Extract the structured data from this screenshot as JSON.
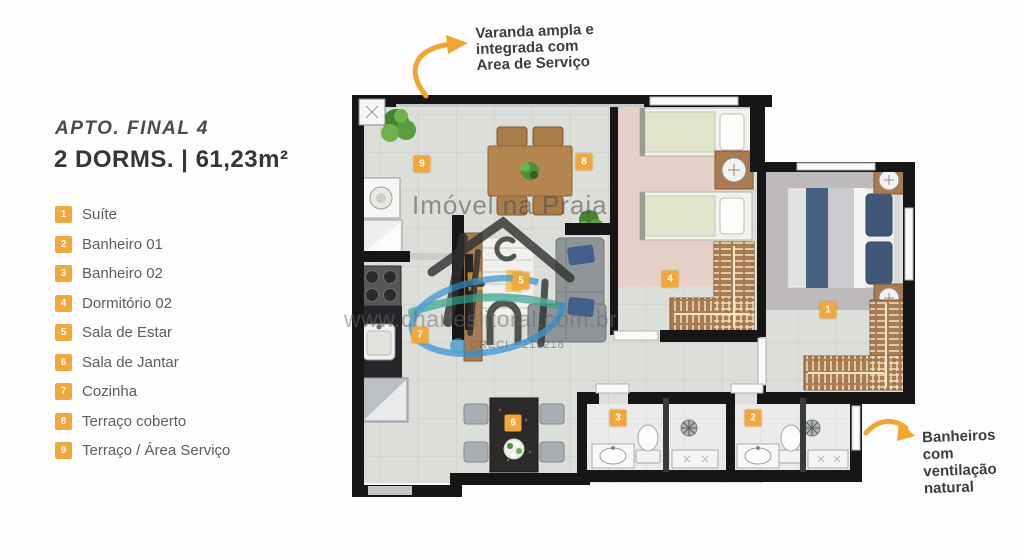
{
  "panel": {
    "title": "APTO. FINAL 4",
    "subtitle": "2 DORMS. | 61,23m²",
    "legend": [
      {
        "num": "1",
        "label": "Suíte"
      },
      {
        "num": "2",
        "label": "Banheiro 01"
      },
      {
        "num": "3",
        "label": "Banheiro 02"
      },
      {
        "num": "4",
        "label": "Dormitório 02"
      },
      {
        "num": "5",
        "label": "Sala de Estar"
      },
      {
        "num": "6",
        "label": "Sala de Jantar"
      },
      {
        "num": "7",
        "label": "Cozinha"
      },
      {
        "num": "8",
        "label": "Terraço coberto"
      },
      {
        "num": "9",
        "label": "Terraço / Área Serviço"
      }
    ]
  },
  "annotations": {
    "varanda": [
      "Varanda ampla e",
      "integrada com",
      "Area de Serviço"
    ],
    "banheiros": [
      "Banheiros",
      "com",
      "ventilação",
      "natural"
    ]
  },
  "watermark": {
    "brand": "Imóvel na Praia",
    "site": "www.charleslitoral.com.br",
    "creci": "CRECI - 219218"
  },
  "plan": {
    "markers": [
      {
        "num": "1",
        "x": 828,
        "y": 310
      },
      {
        "num": "2",
        "x": 753,
        "y": 418
      },
      {
        "num": "3",
        "x": 618,
        "y": 418
      },
      {
        "num": "4",
        "x": 670,
        "y": 279
      },
      {
        "num": "5",
        "x": 521,
        "y": 281
      },
      {
        "num": "6",
        "x": 513,
        "y": 423
      },
      {
        "num": "7",
        "x": 420,
        "y": 335
      },
      {
        "num": "8",
        "x": 584,
        "y": 162
      },
      {
        "num": "9",
        "x": 422,
        "y": 164
      }
    ],
    "colors": {
      "marker": "#F0A73C",
      "wall": "#161616",
      "arrow": "#F2A52F",
      "wood": "#B5854F",
      "dorm_floor": "#E6D1C6"
    }
  }
}
